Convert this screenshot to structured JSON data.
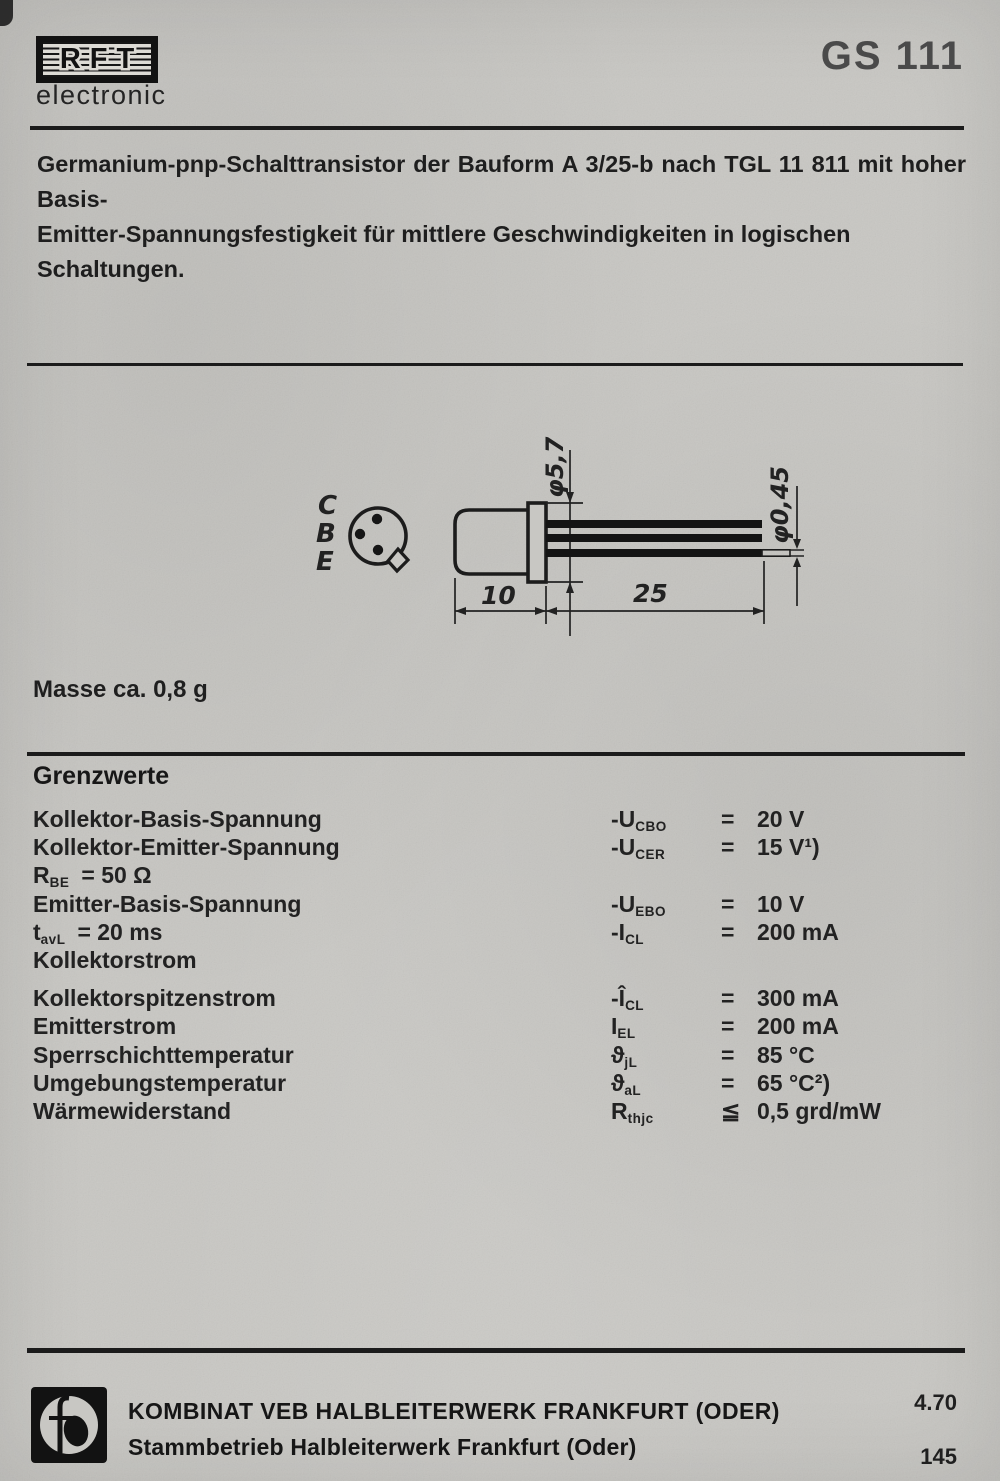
{
  "header": {
    "brand": "RFT",
    "brand_sub": "electronic",
    "part_number": "GS 111"
  },
  "description": {
    "line1": "Germanium-pnp-Schalttransistor der Bauform A 3/25-b nach TGL 11 811 mit hoher Basis-",
    "line2": "Emitter-Spannungsfestigkeit für mittlere Geschwindigkeiten in logischen Schaltungen."
  },
  "drawing": {
    "pin_labels": [
      "C",
      "B",
      "E"
    ],
    "dim_flange_diameter": "φ5,7",
    "dim_lead_diameter": "φ0,45",
    "dim_body_length": "10",
    "dim_lead_length": "25"
  },
  "mass_note": "Masse ca. 0,8 g",
  "grenzwerte": {
    "heading": "Grenzwerte",
    "rows": [
      {
        "label": "Kollektor-Basis-Spannung",
        "sym_pre": "-U",
        "sym_sub": "CBO",
        "rel": "=",
        "value": "20 V"
      },
      {
        "label": "Kollektor-Emitter-Spannung",
        "sym_pre": "-U",
        "sym_sub": "CER",
        "rel": "=",
        "value": "15 V¹)"
      },
      {
        "label_pre": "R",
        "label_sub": "BE",
        "label_rest": "=  50 Ω"
      },
      {
        "label": "Emitter-Basis-Spannung",
        "sym_pre": "-U",
        "sym_sub": "EBO",
        "rel": "=",
        "value": "10 V"
      },
      {
        "label_pre": "t",
        "label_sub": "avL",
        "label_rest": "=  20 ms",
        "sym_pre": "-I",
        "sym_sub": "CL",
        "rel": "=",
        "value": "200 mA"
      },
      {
        "label": "Kollektorstrom"
      },
      {
        "label": "Kollektorspitzenstrom",
        "sym_pre": "-Î",
        "sym_sub": "CL",
        "rel": "=",
        "value": "300 mA"
      },
      {
        "label": "Emitterstrom",
        "sym_pre": "I",
        "sym_sub": "EL",
        "rel": "=",
        "value": "200 mA"
      },
      {
        "label": "Sperrschichttemperatur",
        "sym_pre": "ϑ",
        "sym_sub": "jL",
        "rel": "=",
        "value": "85 °C"
      },
      {
        "label": "Umgebungstemperatur",
        "sym_pre": "ϑ",
        "sym_sub": "aL",
        "rel": "=",
        "value": "65 °C²)"
      },
      {
        "label": "Wärmewiderstand",
        "sym_pre": "R",
        "sym_sub": "thjc",
        "rel": "≦",
        "value": "0,5 grd/mW"
      }
    ]
  },
  "footer": {
    "company_line1": "KOMBINAT VEB HALBLEITERWERK FRANKFURT (ODER)",
    "company_line2": "Stammbetrieb Halbleiterwerk Frankfurt (Oder)",
    "date_code": "4.70",
    "page_number": "145"
  },
  "colors": {
    "paper": "#c8c7c3",
    "ink": "#1f1f1f",
    "part_number_ink": "#4a4a4a"
  }
}
